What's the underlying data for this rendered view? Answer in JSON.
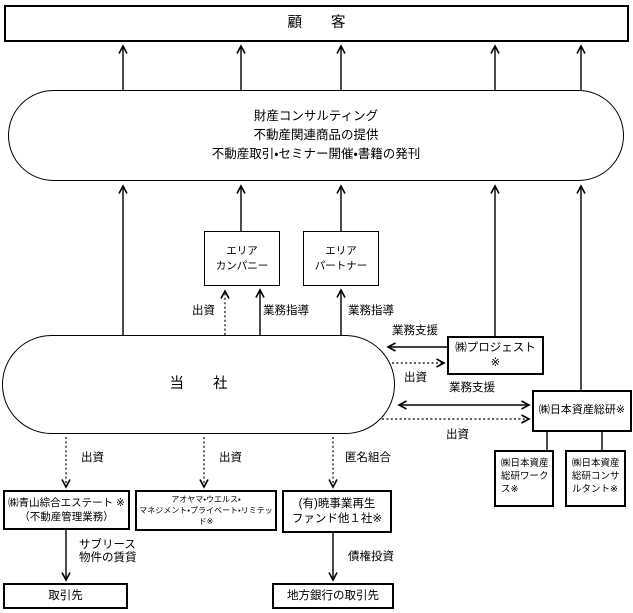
{
  "colors": {
    "line": "#000000",
    "background": "#ffffff",
    "text": "#000000"
  },
  "diagram": {
    "customer_label": "顧　　客",
    "services_lines": [
      "財産コンサルティング",
      "不動産関連商品の提供",
      "不動産取引・セミナー開催・書籍の発刊"
    ],
    "area_company_lines": [
      "エリア",
      "カンパニー"
    ],
    "area_partner_lines": [
      "エリア",
      "パートナー"
    ],
    "our_company_label": "当　　社",
    "projest_label": "㈱プロジェスト ※",
    "soken_label": "㈱日本資産総研※",
    "soken_works_label": "㈱日本資産総研ワークス※",
    "soken_consultant_label": "㈱日本資産総研コンサルタント※",
    "estate_lines": [
      "㈱青山綜合エステート ※",
      "（不動産管理業務）"
    ],
    "wealth_lines": [
      "アオヤマ・ウエルス・",
      "マネジメント・プライベート・リミテッド※"
    ],
    "fund_lines": [
      "(有)暁事業再生",
      "ファンド他１社※"
    ],
    "client_label": "取引先",
    "bank_client_label": "地方銀行の取引先",
    "edge_labels": {
      "invest_area": "出資",
      "guidance_company": "業務指導",
      "guidance_partner": "業務指導",
      "support_projest": "業務支援",
      "invest_projest": "出資",
      "support_soken": "業務支援",
      "invest_soken": "出資",
      "invest_estate": "出資",
      "invest_wealth": "出資",
      "anonymous_partnership": "匿名組合",
      "sublease_lines": [
        "サブリース",
        "物件の賃貸"
      ],
      "debt_investment": "債権投資"
    }
  }
}
